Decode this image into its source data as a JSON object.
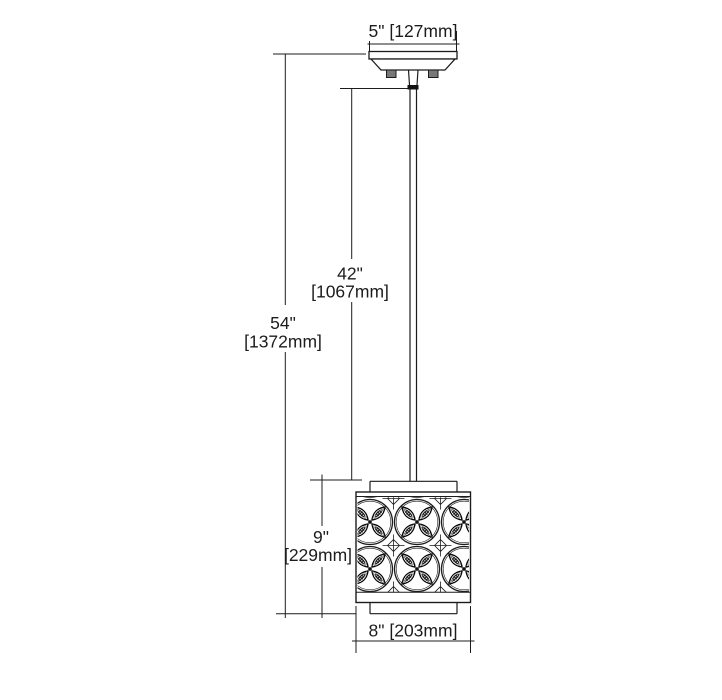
{
  "drawing": {
    "title": "pendant-light-fixture-dimension-diagram",
    "line_color": "#1c1c1c",
    "background_color": "#ffffff",
    "screw_color": "#787878",
    "dimensions": {
      "canopy_width": {
        "label": "5\" [127mm]"
      },
      "overall_height": {
        "inches": "54\"",
        "mm": "[1372mm]"
      },
      "rod_drop": {
        "inches": "42\"",
        "mm": "[1067mm]"
      },
      "shade_height": {
        "inches": "9\"",
        "mm": "[229mm]"
      },
      "shade_width": {
        "label": "8\" [203mm]"
      }
    }
  }
}
